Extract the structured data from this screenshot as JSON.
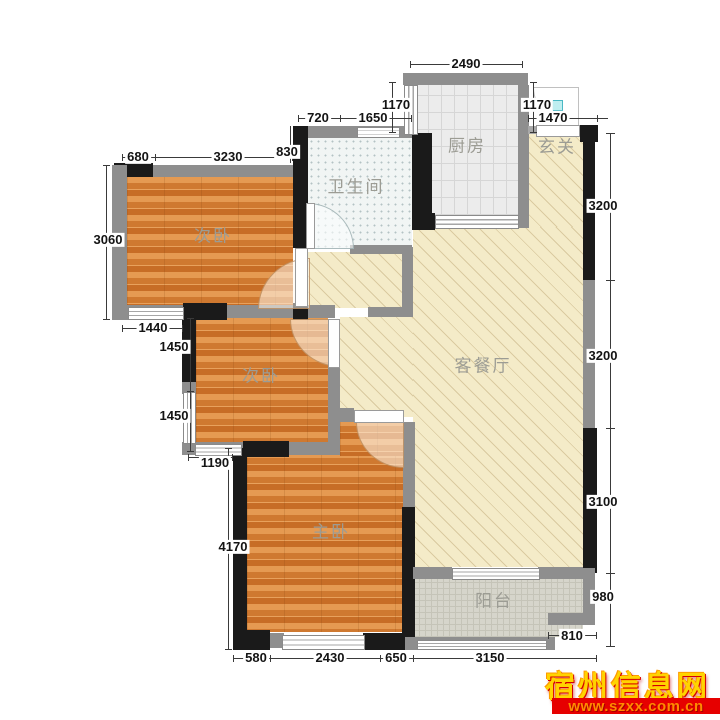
{
  "rooms": {
    "bedroom_top": "次卧",
    "bedroom_mid": "次卧",
    "master": "主卧",
    "bathroom": "卫生间",
    "kitchen": "厨房",
    "entry": "玄关",
    "living": "客餐厅",
    "balcony": "阳台"
  },
  "dims": {
    "bed1_top_left": "680",
    "bed1_top_width": "3230",
    "bed1_left_height": "3060",
    "bath_left_wall": "830",
    "bath_top_seg": "720",
    "bath_top_width": "1650",
    "kitchen_left_window": "1170",
    "kitchen_top_width": "2490",
    "kitchen_right_window": "1170",
    "entry_top_width": "1470",
    "right_upper": "3200",
    "right_middle": "3200",
    "right_lower": "3100",
    "balcony_right_height": "980",
    "balcony_notch": "810",
    "bed1_bottom_window": "1440",
    "bed2_left_upper": "1450",
    "bed2_left_lower": "1450",
    "bed2_bottom_window": "1190",
    "master_left_height": "4170",
    "bottom_seg1": "580",
    "bottom_seg2": "2430",
    "bottom_seg3": "650",
    "bottom_seg4": "3150"
  },
  "watermark": {
    "site_name": "宿州信息网",
    "site_url": "www.szxx.com.cn"
  },
  "colors": {
    "wall_black": "#1a1a1a",
    "wall_gray": "#8e8e8e",
    "wood_floor": "#dd8a42",
    "hall_floor": "#f4ebc8",
    "kitchen_floor": "#ececec",
    "bathroom_floor": "#f1f5f4",
    "balcony_floor": "#d6d5cb",
    "watermark_yellow": "#ffd400",
    "watermark_red": "#e60000",
    "entry_marker_cyan": "#bfeef0"
  }
}
